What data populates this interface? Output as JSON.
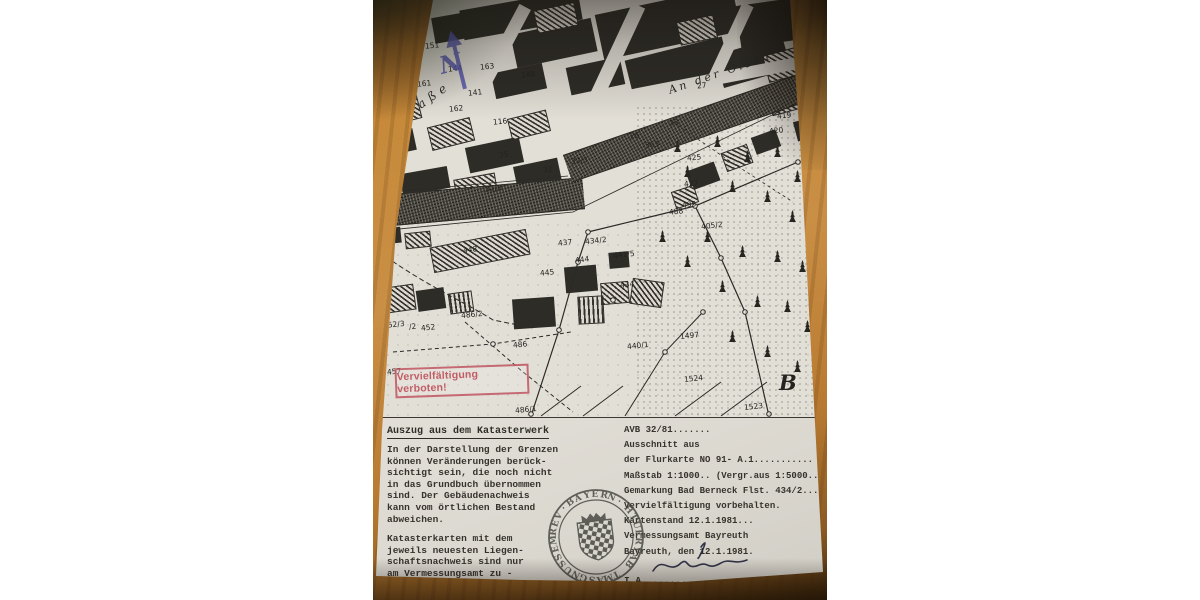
{
  "map": {
    "north_label": "N",
    "street_label": "Straße",
    "river_street_label": "An der Ölsch",
    "section_letter": "B",
    "prohibition_stamp": "Vervielfältigung verboten!",
    "parcel_labels": [
      {
        "t": "151",
        "x": 52,
        "y": 41
      },
      {
        "t": "144",
        "x": 75,
        "y": 64
      },
      {
        "t": "163",
        "x": 107,
        "y": 62
      },
      {
        "t": "161",
        "x": 44,
        "y": 79
      },
      {
        "t": "148",
        "x": 148,
        "y": 70
      },
      {
        "t": "162",
        "x": 76,
        "y": 104
      },
      {
        "t": "116",
        "x": 120,
        "y": 117
      },
      {
        "t": "141",
        "x": 95,
        "y": 88
      },
      {
        "t": "35",
        "x": 126,
        "y": 150
      },
      {
        "t": "32",
        "x": 170,
        "y": 165
      },
      {
        "t": "32/3",
        "x": 198,
        "y": 156
      },
      {
        "t": "32/8",
        "x": 112,
        "y": 184
      },
      {
        "t": "26",
        "x": 257,
        "y": 131
      },
      {
        "t": "363",
        "x": 272,
        "y": 140
      },
      {
        "t": "23",
        "x": 296,
        "y": 118
      },
      {
        "t": "27",
        "x": 324,
        "y": 81
      },
      {
        "t": "419",
        "x": 404,
        "y": 111
      },
      {
        "t": "420",
        "x": 396,
        "y": 126
      },
      {
        "t": "425",
        "x": 314,
        "y": 153
      },
      {
        "t": "427",
        "x": 311,
        "y": 179
      },
      {
        "t": "495",
        "x": 309,
        "y": 200
      },
      {
        "t": "488",
        "x": 296,
        "y": 207
      },
      {
        "t": "405/2",
        "x": 328,
        "y": 221
      },
      {
        "t": "437",
        "x": 185,
        "y": 238
      },
      {
        "t": "434/2",
        "x": 212,
        "y": 236
      },
      {
        "t": "444",
        "x": 202,
        "y": 255
      },
      {
        "t": "441/5",
        "x": 240,
        "y": 250
      },
      {
        "t": "445",
        "x": 167,
        "y": 268
      },
      {
        "t": "434",
        "x": 247,
        "y": 280
      },
      {
        "t": "448",
        "x": 90,
        "y": 245
      },
      {
        "t": "440/1",
        "x": 254,
        "y": 341
      },
      {
        "t": "1497",
        "x": 307,
        "y": 331
      },
      {
        "t": "1524",
        "x": 311,
        "y": 374
      },
      {
        "t": "1523",
        "x": 371,
        "y": 402
      },
      {
        "t": "486/2",
        "x": 88,
        "y": 310
      },
      {
        "t": "452/3",
        "x": 10,
        "y": 320
      },
      {
        "t": "/2",
        "x": 36,
        "y": 322
      },
      {
        "t": "452",
        "x": 48,
        "y": 323
      },
      {
        "t": "486",
        "x": 140,
        "y": 340
      },
      {
        "t": "457",
        "x": 14,
        "y": 367
      },
      {
        "t": "486/1",
        "x": 142,
        "y": 405
      }
    ],
    "tree_positions": [
      [
        300,
        140
      ],
      [
        340,
        135
      ],
      [
        370,
        150
      ],
      [
        400,
        145
      ],
      [
        420,
        170
      ],
      [
        310,
        165
      ],
      [
        355,
        180
      ],
      [
        390,
        190
      ],
      [
        415,
        210
      ],
      [
        330,
        230
      ],
      [
        365,
        245
      ],
      [
        400,
        250
      ],
      [
        425,
        260
      ],
      [
        345,
        280
      ],
      [
        380,
        295
      ],
      [
        410,
        300
      ],
      [
        430,
        320
      ],
      [
        355,
        330
      ],
      [
        390,
        345
      ],
      [
        420,
        360
      ],
      [
        310,
        255
      ],
      [
        285,
        230
      ]
    ]
  },
  "notice": {
    "heading": "Auszug aus dem Katasterwerk",
    "para1": "In der Darstellung der Grenzen\nkönnen Veränderungen berück-\nsichtigt sein, die noch nicht\nin das Grundbuch übernommen\nsind. Der Gebäudenachweis\nkann vom örtlichen Bestand\nabweichen.",
    "para2": "Katasterkarten mit dem\njeweils neuesten Liegen-\nschaftsnachweis sind nur\nam Vermessungsamt zu  -\nbeziehen.",
    "note_prefix": "Bestnahme ",
    "note_emphasis": "bedingt",
    "note_suffix": " geeignet!"
  },
  "form": {
    "block": "AVB  32/81.......\nAusschnitt aus\nder Flurkarte NO 91- A.1...........\nMaßstab 1:1000.. (Vergr.aus 1:5000...\nGemarkung Bad Berneck Flst. 434/2...\nVervielfältigung vorbehalten.\nKartenstand 12.1.1981...\nVermessungsamt Bayreuth\nBayreuth, den 12.1.1981.",
    "ia_line": "I.A. ................."
  },
  "seal": {
    "ring_top": "·BAYERN·",
    "ring_bottom": "VERMESSUNGSAMT BAYREUTH"
  },
  "colors": {
    "stamp_red": "#c05560",
    "north_arrow_blue": "#5858b2",
    "paper": "#e8e5de",
    "wood": "#b97c33",
    "map_ink": "#2e2c27"
  }
}
